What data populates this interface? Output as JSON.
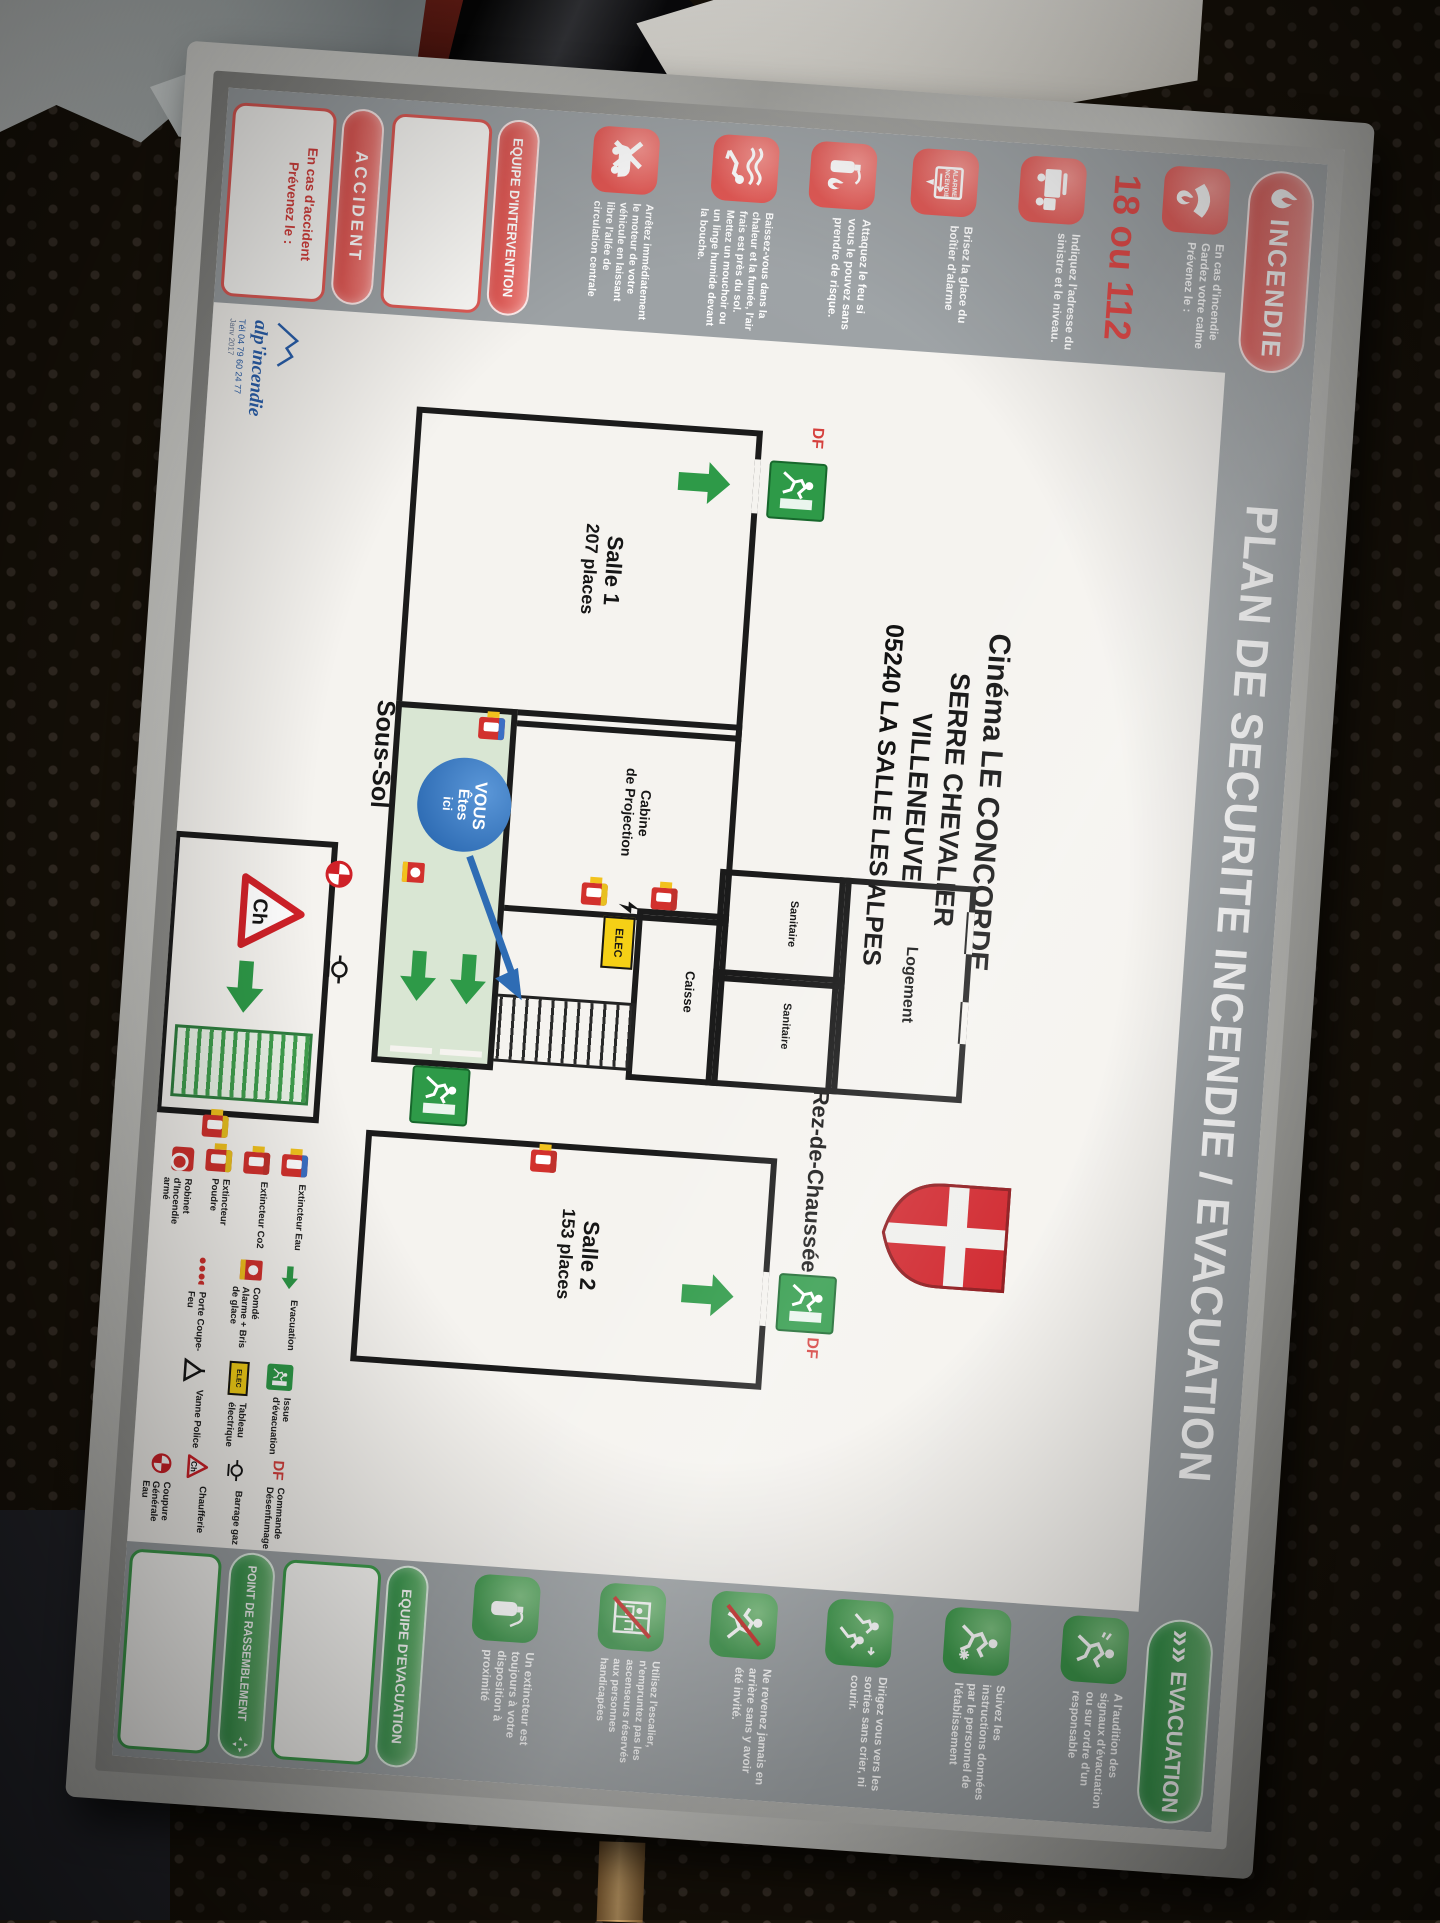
{
  "colors": {
    "incendie_red": "#e2534f",
    "evacuation_green": "#3f9e4d",
    "strip_gray": "#9da2a5",
    "you_are_here_blue": "#2e6cb4",
    "elec_yellow": "#f5d016"
  },
  "poster": {
    "header": {
      "incendie_label": "INCENDIE",
      "title": "PLAN DE SECURITE INCENDIE / EVACUATION",
      "evacuation_label": "EVACUATION",
      "evacuation_arrows": "»»"
    },
    "fire_column": {
      "instructions": [
        {
          "icon": "phone-flame-icon",
          "text": "En cas d'incendie Gardez votre calme Prévenez le :"
        },
        {
          "icon": "fire-truck-icon",
          "text": "Indiquez l'adresse du sinistre et le niveau."
        },
        {
          "icon": "alarm-hand-icon",
          "text": "Brisez la glace du boîtier d'alarme"
        },
        {
          "icon": "extinguisher-fire-icon",
          "text": "Attaquez le feu si vous le pouvez sans prendre de risque."
        },
        {
          "icon": "crawl-smoke-icon",
          "text": "Baissez-vous dans la chaleur et la fumée, l'air frais est près du sol. Mettez un mouchoir ou un linge humide devant la bouche."
        },
        {
          "icon": "car-crossed-icon",
          "text": "Arrêtez immédiatement le moteur de votre véhicule en laissant libre l'allée de circulation centrale"
        }
      ],
      "emergency_numbers": "18 ou 112",
      "alarm_box_line1": "ALARME",
      "alarm_box_line2": "INCENDIE",
      "intervention_label": "EQUIPE D'INTERVENTION",
      "accident_label": "ACCIDENT",
      "accident_note": "En cas d'accident Prévenez le :"
    },
    "evacuation_column": {
      "instructions": [
        {
          "icon": "runner-alarm-icon",
          "text": "A l'audition des signaux d'évacuation ou sur ordre d'un responsable"
        },
        {
          "icon": "runner-follow-icon",
          "text": "Suivez les instructions données par le personnel de l'établissement"
        },
        {
          "icon": "runners-exit-icon",
          "text": "Dirigez vous vers les sorties sans crier, ni courir."
        },
        {
          "icon": "no-return-icon",
          "text": "Ne revenez jamais en arrière sans y avoir été invité."
        },
        {
          "icon": "no-elevator-icon",
          "text": "Utilisez l'escalier, n'empruntez pas les ascenseurs réservés aux personnes handicapées"
        },
        {
          "icon": "extinguisher-icon",
          "text": "Un extincteur est toujours à votre disposition à proximité"
        }
      ],
      "equipe_label": "EQUIPE D'EVACUATION",
      "rassemblement_label": "POINT DE RASSEMBLEMENT"
    },
    "plan": {
      "address_lines": [
        "Cinéma LE CONCORDE",
        "SERRE CHEVALIER",
        "VILLENEUVE",
        "05240 LA SALLE LES ALPES"
      ],
      "floor_basement": "Sous-Sol",
      "floor_ground": "Rez-de-Chaussée",
      "salle1_name": "Salle 1",
      "salle1_capacity": "207 places",
      "salle2_name": "Salle 2",
      "salle2_capacity": "153 places",
      "caisse": "Caisse",
      "cabine_line1": "Cabine",
      "cabine_line2": "de Projection",
      "sanitaire_a": "Sanitaire",
      "sanitaire_b": "Sanitaire",
      "logement": "Logement",
      "you_are_here": [
        "VOUS",
        "Êtes",
        "ici"
      ],
      "elec": "ELEC",
      "chaufferie_mark": "Ch",
      "df": "DF"
    },
    "legend": {
      "col1": [
        {
          "icon": "extinguisher-water-icon",
          "label": "Extincteur Eau"
        },
        {
          "icon": "extinguisher-co2-icon",
          "label": "Extincteur Co2"
        },
        {
          "icon": "extinguisher-powder-icon",
          "label": "Extincteur Poudre"
        },
        {
          "icon": "fire-hose-reel-icon",
          "label": "Robinet d'Incendie armé"
        }
      ],
      "col2": [
        {
          "icon": "green-arrow-icon",
          "label": "Evacuation"
        },
        {
          "icon": "alarm-box-icon",
          "label": "Comdé Alarme + Bris de glace"
        },
        {
          "icon": "fire-door-icon",
          "label": "Porte Coupe-Feu"
        }
      ],
      "col3": [
        {
          "icon": "exit-sign-icon",
          "label": "Issue d'évacuation"
        },
        {
          "icon": "electrical-panel-icon",
          "label": "Tableau électrique"
        },
        {
          "icon": "police-valve-icon",
          "label": "Vanne Police"
        }
      ],
      "col4": [
        {
          "icon": "smoke-control-icon",
          "label": "Commande Désenfumage"
        },
        {
          "icon": "gas-valve-icon",
          "label": "Barrage gaz"
        },
        {
          "icon": "boiler-icon",
          "label": "Chaufferie"
        },
        {
          "icon": "water-cutoff-icon",
          "label": "Coupure Générale Eau"
        }
      ],
      "df_symbol": "DF",
      "elec_symbol": "ELEC",
      "chaufferie_symbol": "Ch"
    },
    "logo": {
      "brand": "alp'incendie",
      "phone": "Tél 04 79 60 24 77",
      "date": "Janv 2017"
    }
  }
}
